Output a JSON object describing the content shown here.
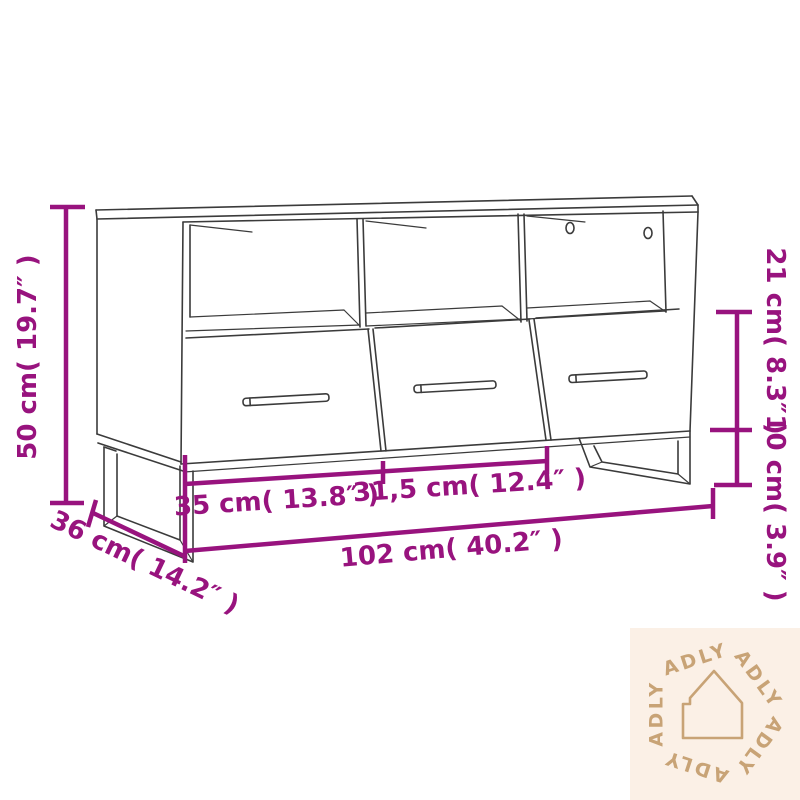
{
  "diagram": {
    "title": "tv-cabinet-dimension-diagram",
    "accent_color": "#98137E",
    "line_color": "#3b3b3b",
    "labels": {
      "height": "50 cm( 19.7″ )",
      "compartment_height": "21 cm( 8.3″ )",
      "leg_height": "10 cm( 3.9″ )",
      "left_section_width": "35 cm( 13.8″ )",
      "middle_section_width": "31,5 cm( 12.4″ )",
      "total_width": "102 cm( 40.2″ )",
      "depth": "36 cm( 14.2″ )"
    }
  },
  "watermark": {
    "brand": "ADLY",
    "bg_color": "#FBF0E6",
    "fg_color": "#C8A376",
    "icon": "house-outline-icon"
  }
}
